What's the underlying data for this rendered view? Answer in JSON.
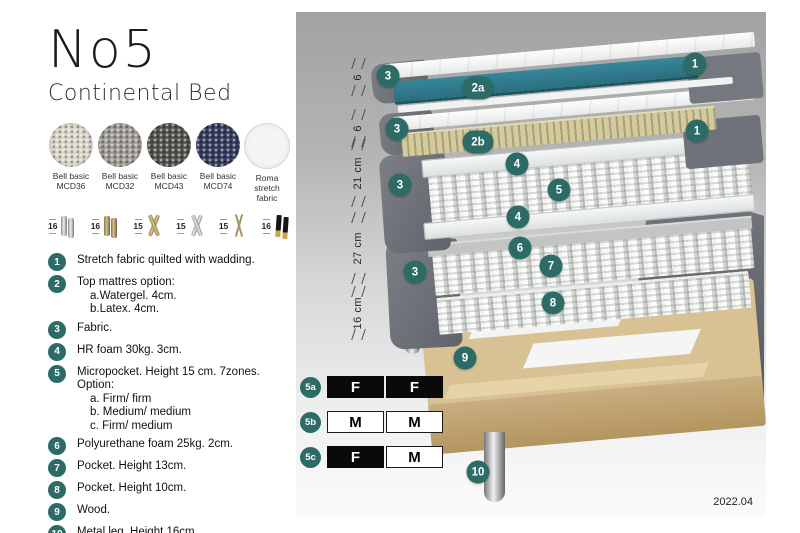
{
  "header": {
    "title": "No5",
    "subtitle": "Continental Bed"
  },
  "fabrics": [
    {
      "name": "Bell basic",
      "code": "MCD36",
      "color": "#d9d4c8",
      "woven": true
    },
    {
      "name": "Bell basic",
      "code": "MCD32",
      "color": "#9d9a93",
      "woven": true
    },
    {
      "name": "Bell basic",
      "code": "MCD43",
      "color": "#54544e",
      "woven": true
    },
    {
      "name": "Bell basic",
      "code": "MCD74",
      "color": "#363d5e",
      "woven": true
    },
    {
      "name": "Roma",
      "code": "stretch fabric",
      "color": "#f4f4f4",
      "woven": false
    }
  ],
  "legs": [
    {
      "height": "16",
      "type": "chrome-cylinder"
    },
    {
      "height": "16",
      "type": "brass-cylinder"
    },
    {
      "height": "15",
      "type": "gold-cross"
    },
    {
      "height": "15",
      "type": "silver-cross"
    },
    {
      "height": "15",
      "type": "hairpin"
    },
    {
      "height": "16",
      "type": "black-gold"
    }
  ],
  "parts": [
    {
      "num": "1",
      "text": "Stretch fabric quilted with wadding.",
      "sub": []
    },
    {
      "num": "2",
      "text": "Top mattres option:",
      "sub": [
        "a.Watergel. 4cm.",
        "b.Latex. 4cm."
      ]
    },
    {
      "num": "3",
      "text": "Fabric.",
      "sub": []
    },
    {
      "num": "4",
      "text": "HR foam 30kg. 3cm.",
      "sub": []
    },
    {
      "num": "5",
      "text": "Micropocket. Height 15 cm. 7zones. Option:",
      "sub": [
        "a. Firm/ firm",
        "b. Medium/ medium",
        "c. Firm/ medium"
      ]
    },
    {
      "num": "6",
      "text": "Polyurethane foam 25kg. 2cm.",
      "sub": []
    },
    {
      "num": "7",
      "text": "Pocket. Height 13cm.",
      "sub": []
    },
    {
      "num": "8",
      "text": "Pocket. Height 10cm.",
      "sub": []
    },
    {
      "num": "9",
      "text": "Wood.",
      "sub": []
    },
    {
      "num": "10",
      "text": "Metal leg. Height 16cm.",
      "sub": []
    }
  ],
  "diagram": {
    "dimensions": [
      "6",
      "6",
      "21 cm",
      "27 cm",
      "16 cm"
    ],
    "badges": [
      "3",
      "2a",
      "1",
      "3",
      "2b",
      "1",
      "4",
      "3",
      "5",
      "4",
      "6",
      "7",
      "3",
      "8",
      "9",
      "10"
    ]
  },
  "firmness": {
    "rows": [
      {
        "label": "5a",
        "cells": [
          {
            "text": "F",
            "variant": "dark"
          },
          {
            "text": "F",
            "variant": "dark"
          }
        ]
      },
      {
        "label": "5b",
        "cells": [
          {
            "text": "M",
            "variant": "light"
          },
          {
            "text": "M",
            "variant": "light"
          }
        ]
      },
      {
        "label": "5c",
        "cells": [
          {
            "text": "F",
            "variant": "dark"
          },
          {
            "text": "M",
            "variant": "light"
          }
        ]
      }
    ]
  },
  "version": "2022.04",
  "colors": {
    "badge_teal": "#2d6b67",
    "watergel_teal": "#2e7e8e",
    "fabric_gray": "#6b6e75",
    "wood_tan": "#d8c193"
  }
}
